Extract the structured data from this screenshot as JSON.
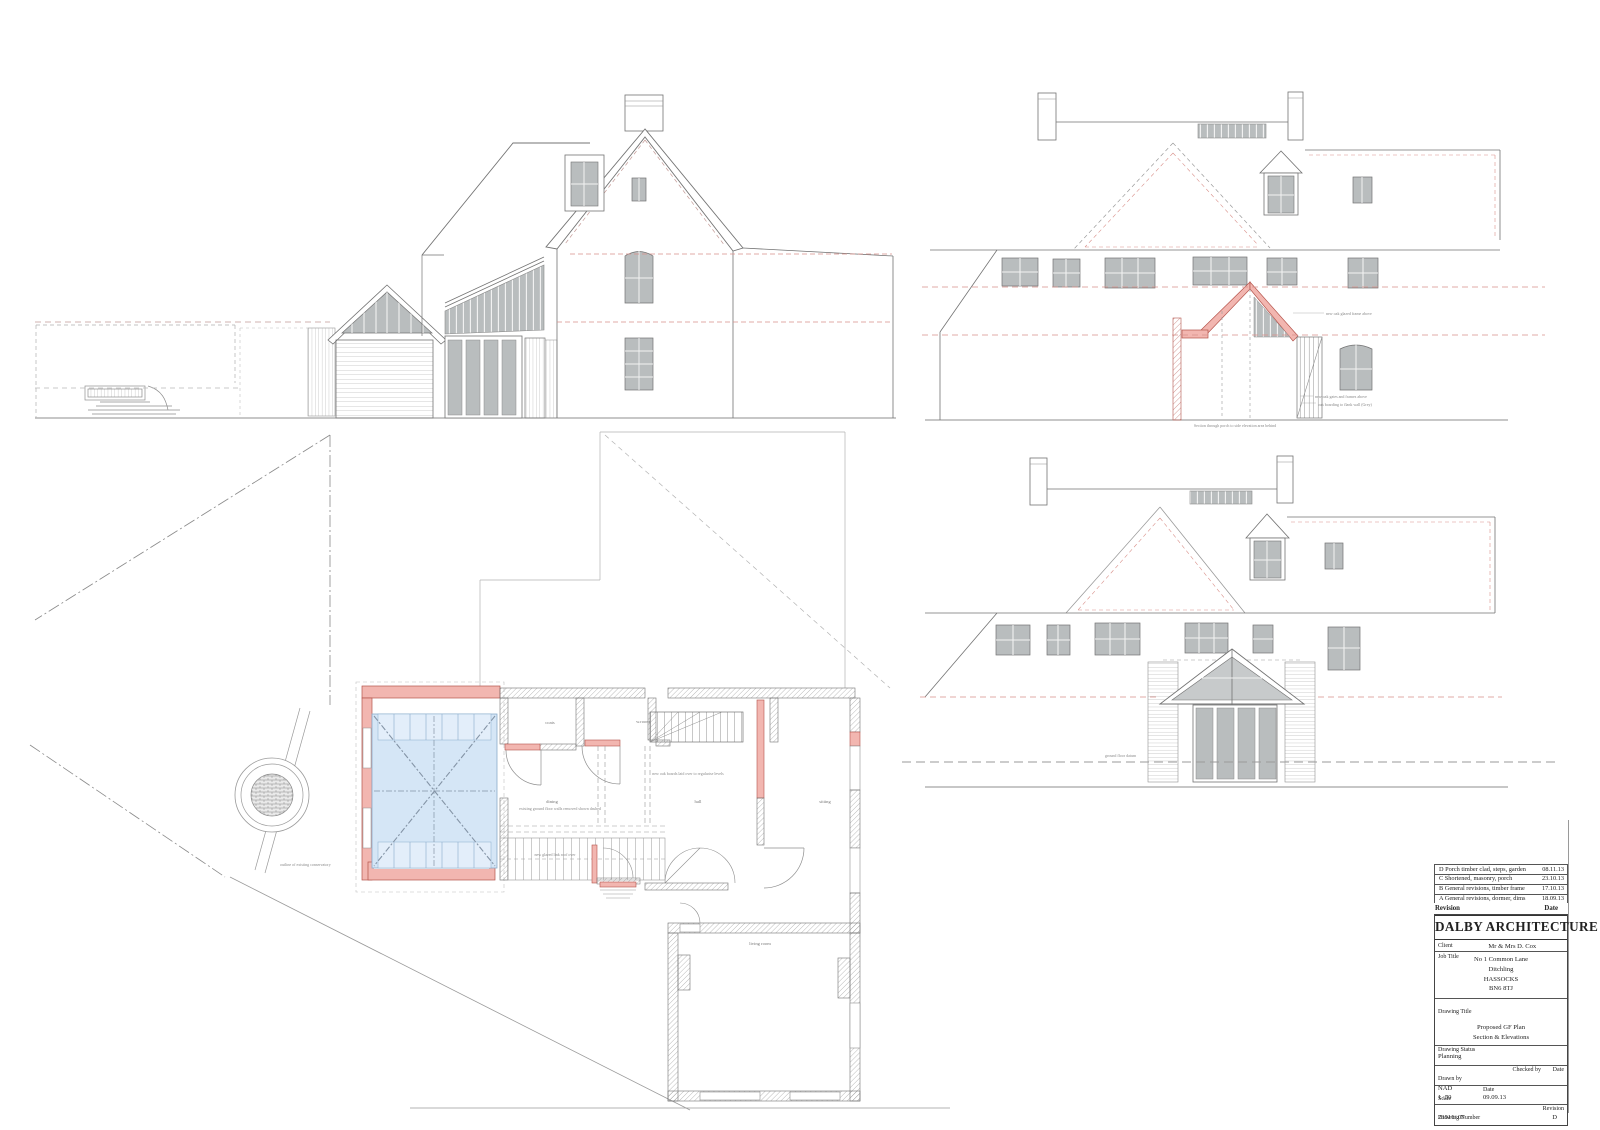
{
  "sheet": {
    "colors": {
      "line": "#737373",
      "light_line": "#a6a6a6",
      "new_work_pink": "#f2b6b0",
      "new_work_stroke": "#b5544c",
      "glazed_roof_blue": "#d5e6f6",
      "glazing_grey": "#b9bdbe",
      "datum_red": "#d9908a"
    }
  },
  "views": {
    "side_elevation": {
      "name": "side elevation"
    },
    "section": {
      "name": "section",
      "annotations": [
        "new oak glazed frame above",
        "new oak gates and frames above",
        "oak boarding to flank wall (Grey)",
        "Section through porch to side elevation area behind"
      ]
    },
    "rear_elevation": {
      "name": "rear elevation",
      "annotations": [
        "ground floor datum"
      ]
    },
    "plan": {
      "name": "proposed ground floor plan",
      "room_labels": [
        {
          "text": "coats"
        },
        {
          "text": "w.room"
        },
        {
          "text": "dining"
        },
        {
          "text": "hall"
        },
        {
          "text": "sitting"
        },
        {
          "text": "living room"
        }
      ],
      "notes": [
        "outline of existing conservatory",
        "existing ground floor walls removed shown dashed",
        "new oak boards laid over to regularise levels",
        "new glazed link roof over"
      ]
    }
  },
  "revision_table": {
    "rows": [
      {
        "desc": "D Porch timber clad, steps, garden",
        "date": "08.11.13"
      },
      {
        "desc": "C Shortened, masonry, porch",
        "date": "23.10.13"
      },
      {
        "desc": "B General revisions, timber frame",
        "date": "17.10.13"
      },
      {
        "desc": "A General revisions, dormer, dims",
        "date": "18.09.13"
      }
    ],
    "footer": {
      "revision": "Revision",
      "date": "Date"
    }
  },
  "title_block": {
    "firm": "DALBY ARCHITECTURE",
    "client_label": "Client",
    "client": "Mr & Mrs D. Cox",
    "job_title_label": "Job Title",
    "job_address": [
      "No 1 Common Lane",
      "Ditchling",
      "HASSOCKS",
      "BN6 8TJ"
    ],
    "drawing_title_label": "Drawing Title",
    "drawing_title_lines": [
      "Proposed GF Plan",
      "Section & Elevations"
    ],
    "status_label": "Drawing Status",
    "status": "Planning",
    "drawn_by_label": "Drawn by",
    "drawn_by": "NAD",
    "checked_by_label": "Checked by",
    "date_label": "Date",
    "scale_label": "Scale",
    "scale": "1 :50",
    "date": "09.09.13",
    "number_label": "Drawing Number",
    "number": "23516/ 07",
    "revision_label": "Revision",
    "revision": "D"
  }
}
